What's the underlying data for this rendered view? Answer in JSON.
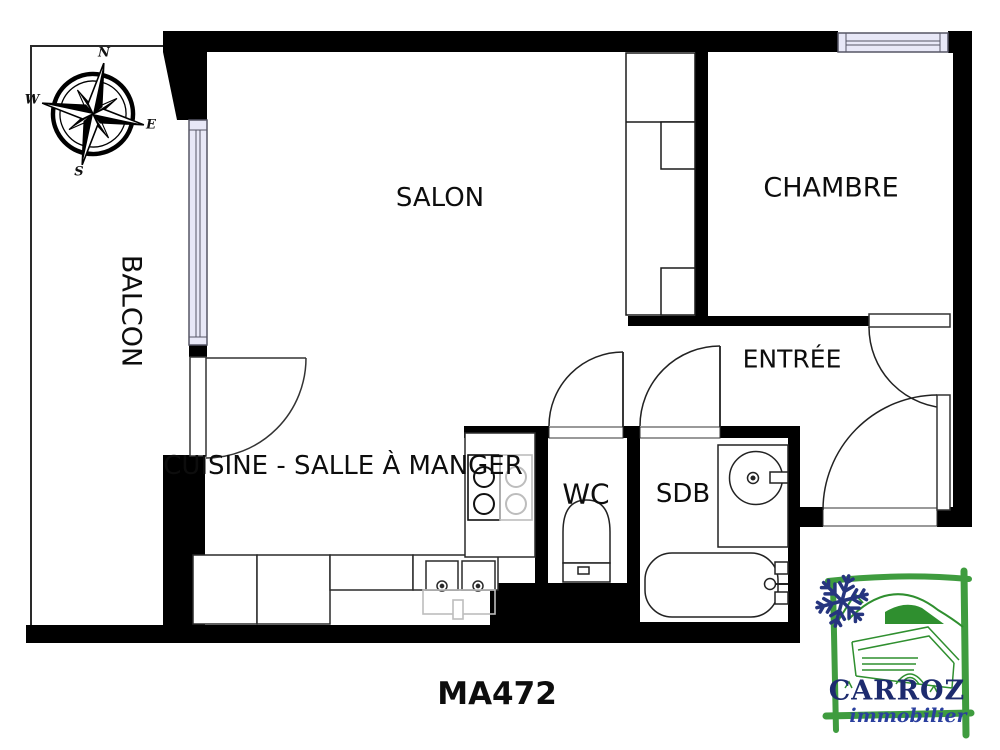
{
  "reference": "MA472",
  "rooms": {
    "salon": "SALON",
    "chambre": "CHAMBRE",
    "balcon": "BALCON",
    "entree": "ENTRÉE",
    "cuisine": "CUISINE - SALLE À MANGER",
    "wc": "WC",
    "sdb": "SDB"
  },
  "compass": {
    "north": "N",
    "east": "E",
    "south": "S",
    "west": "W"
  },
  "logo": {
    "brand": "CARROZ",
    "tagline": "immobilier"
  },
  "colors": {
    "wall": "#000000",
    "line": "#1b1b1b",
    "window_fill": "#e8e8f7",
    "window_border": "#565665",
    "ghost_appliance": "#bdbdbd",
    "logo_green": "#3F9C3F",
    "logo_art_green": "#2F8F2F",
    "logo_navy": "#1D2B6E",
    "logo_blue": "#2A3F9E",
    "snowflake_blue": "#26357F"
  }
}
